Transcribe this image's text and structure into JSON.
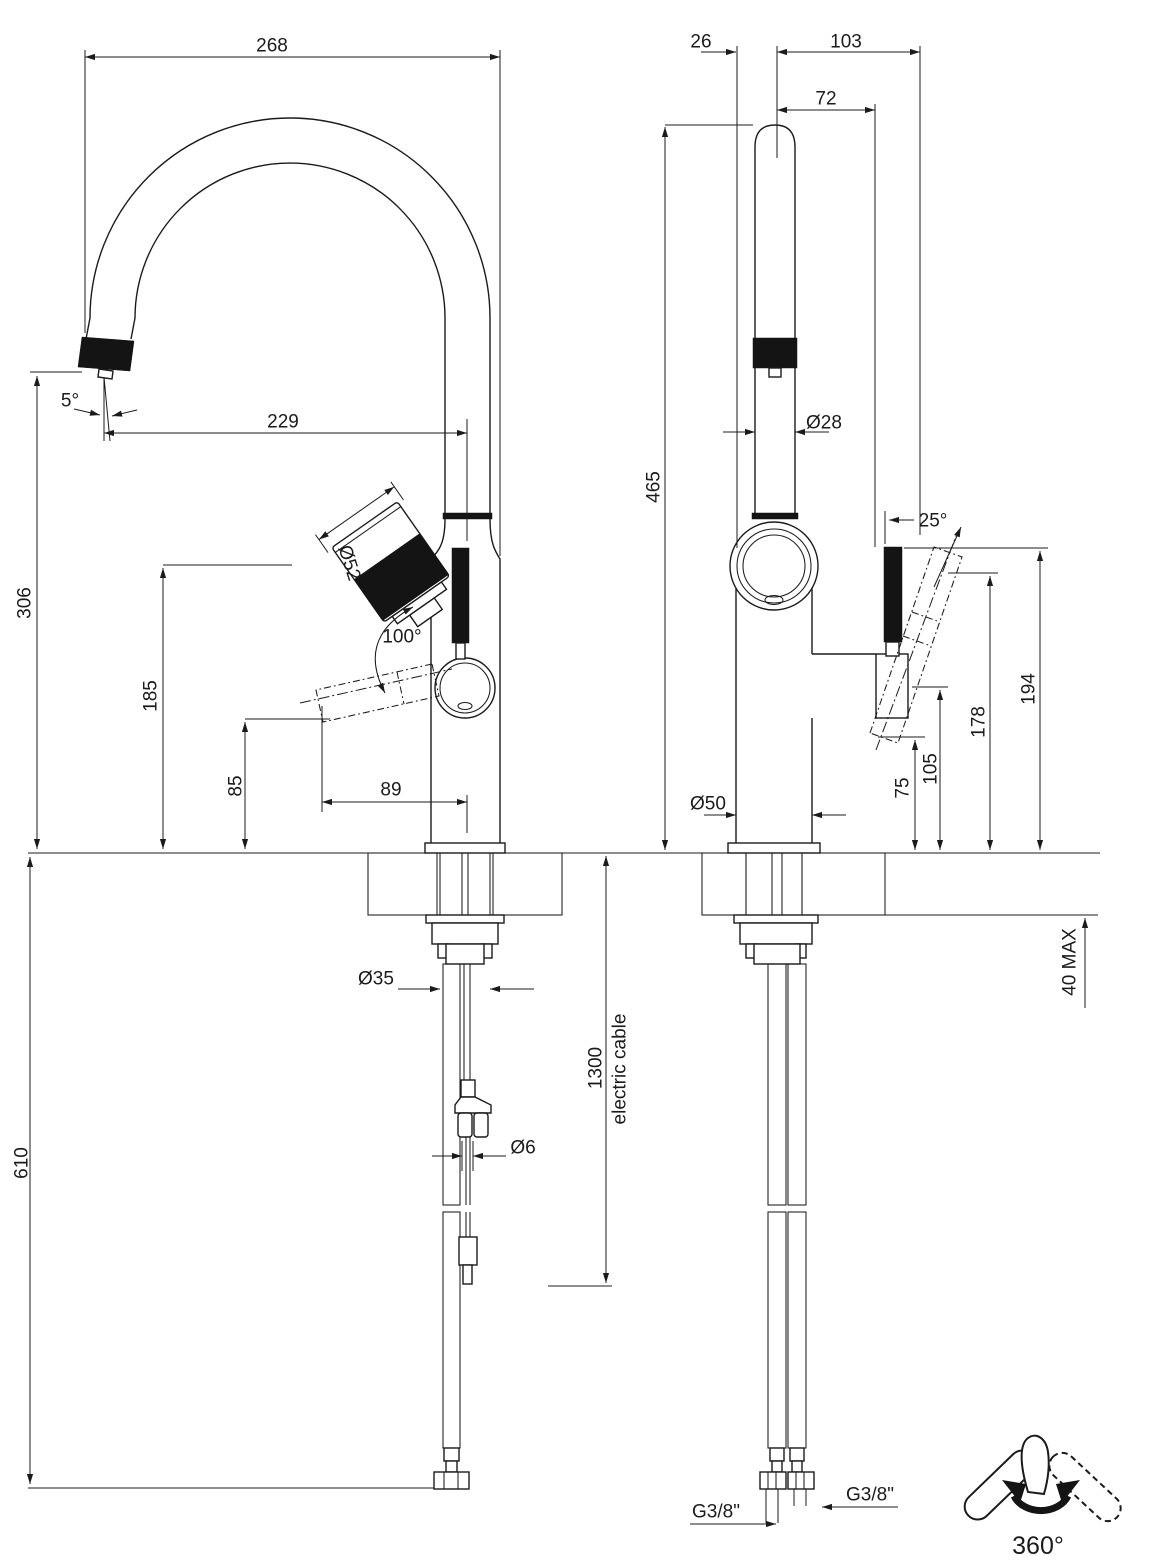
{
  "side_view": {
    "spout_width": "268",
    "spout_angle": "5°",
    "spout_reach": "229",
    "spout_height": "306",
    "lever_height": "185",
    "handle_down_height": "85",
    "handle_reach": "89",
    "handle_diameter": "Ø52",
    "handle_rotation": "100°",
    "under_counter_length": "610",
    "shank_diameter": "Ø35",
    "cable_length": "1300",
    "cable_note": "electric cable",
    "cable_diameter": "Ø6"
  },
  "front_view": {
    "knob_to_axis": "26",
    "axis_to_handle": "103",
    "axis_to_lever": "72",
    "overall_height": "465",
    "spout_diameter": "Ø28",
    "handle_tilt": "25°",
    "lever_top_height": "194",
    "handle_top_height": "178",
    "mount_height": "105",
    "handle_bottom_height": "75",
    "base_diameter": "Ø50",
    "max_counter_thickness": "40 MAX",
    "hose_thread_left": "G3/8\"",
    "hose_thread_right": "G3/8\""
  },
  "swivel_icon": {
    "label": "360°"
  },
  "colors": {
    "line": "#1b1b1b",
    "background": "#ffffff"
  }
}
